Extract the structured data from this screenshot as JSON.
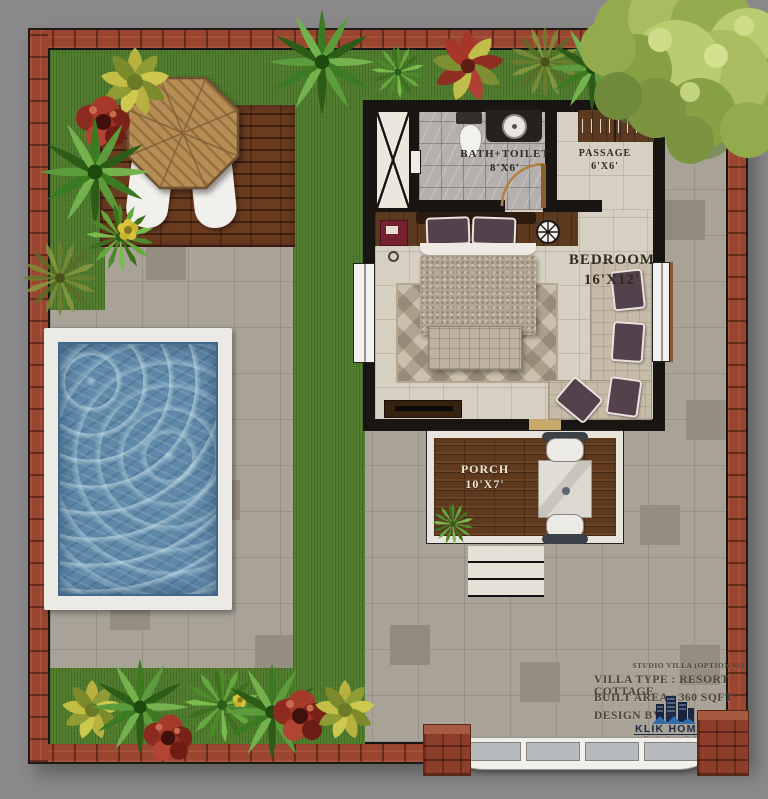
{
  "plan": {
    "rooms": {
      "bath": {
        "name": "BATH+TOILET",
        "size": "8'X6'"
      },
      "passage": {
        "name": "PASSAGE",
        "size": "6'X6'"
      },
      "bedroom": {
        "name": "BEDROOM",
        "size": "16'X12'"
      },
      "porch": {
        "name": "PORCH",
        "size": "10'X7'"
      }
    },
    "info": {
      "option": "STUDIO VILLA (OPTION 01)",
      "villa_type": "VILLA TYPE : RESORT COTTAGE",
      "built_area": "BUILT AREA : 360 SQFT",
      "design_by": "DESIGN BY :"
    },
    "brand": {
      "name": "KLIK HOMES",
      "tagline": "Creating Homes For Life"
    },
    "colors": {
      "background": "#8a888a",
      "brick_border": "#99452f",
      "grass": "#4e7a2b",
      "pavers": "#a8a396",
      "pool_water": "#5f89a9",
      "deck_wood": "#6b3b20",
      "wall": "#181512",
      "bedroom_floor": "#d6d0c2",
      "bath_tile": "#b4b0ad",
      "brand_navy": "#1b2945",
      "brand_red": "#9e3224"
    }
  }
}
